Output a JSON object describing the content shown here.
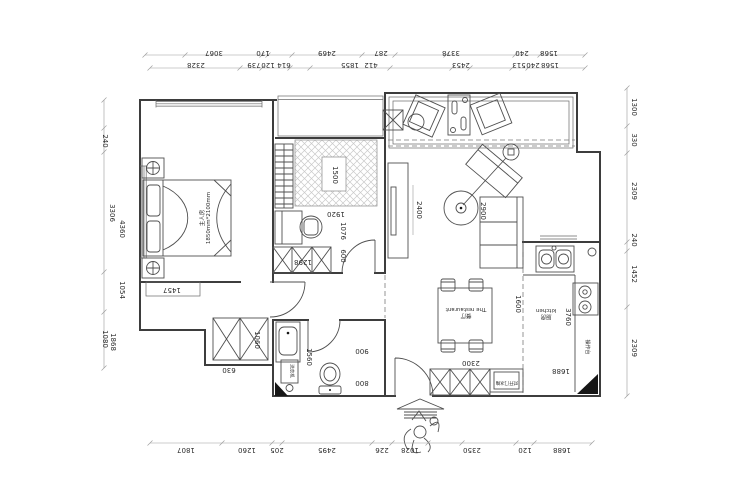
{
  "canvas": {
    "width": 740,
    "height": 500,
    "background": "#ffffff"
  },
  "colors": {
    "wall_line": "#3d3d3d",
    "furniture_line": "#4f4f4f",
    "dimension_line": "#9a9a9a",
    "text": "#2b2b2b",
    "hatch": "#c9c9c9",
    "solid_fill": "#161616"
  },
  "rooms": {
    "master_bedroom": {
      "name": "主人房",
      "size_note": "1850mm*2100mm"
    },
    "dining": {
      "name": "餐厅",
      "subtitle": "The restaurant"
    },
    "kitchen": {
      "name": "厨房",
      "subtitle": "kitchen"
    },
    "counter": {
      "name": "操作台"
    },
    "washing_machine": {
      "name": "洗衣机"
    },
    "fridge_cabinet": {
      "name": "对开门冰箱"
    }
  },
  "dimensions": {
    "top_row_1": [
      "3067",
      "170",
      "2469",
      "287",
      "3378",
      "240",
      "1568"
    ],
    "top_row_2": [
      "2328",
      "739",
      "120",
      "614",
      "1855",
      "412",
      "2453",
      "513",
      "240",
      "1568"
    ],
    "bottom_row": [
      "1807",
      "1260",
      "205",
      "2495",
      "226",
      "1028",
      "2350",
      "120",
      "1688"
    ],
    "left_column": [
      "240",
      "3306",
      "4360",
      "1054",
      "1080",
      "1868"
    ],
    "right_column": [
      "1300",
      "330",
      "2309",
      "240",
      "1452",
      "2309"
    ],
    "interior": [
      "1500",
      "1920",
      "1076",
      "600",
      "1298",
      "1457",
      "1060",
      "630",
      "1560",
      "900",
      "800",
      "2400",
      "2900",
      "1600",
      "3760",
      "2300",
      "1688"
    ]
  },
  "plan_labels": [
    {
      "name": "dim-label",
      "t": "3067",
      "x": 214,
      "y": 52,
      "r": 180
    },
    {
      "name": "dim-label",
      "t": "170",
      "x": 263,
      "y": 52,
      "r": 180
    },
    {
      "name": "dim-label",
      "t": "2469",
      "x": 327,
      "y": 52,
      "r": 180
    },
    {
      "name": "dim-label",
      "t": "287",
      "x": 381,
      "y": 52,
      "r": 180
    },
    {
      "name": "dim-label",
      "t": "3378",
      "x": 451,
      "y": 52,
      "r": 180
    },
    {
      "name": "dim-label",
      "t": "240",
      "x": 522,
      "y": 52,
      "r": 180
    },
    {
      "name": "dim-label",
      "t": "1568",
      "x": 549,
      "y": 52,
      "r": 180
    },
    {
      "name": "dim-label",
      "t": "2328",
      "x": 196,
      "y": 64,
      "r": 180
    },
    {
      "name": "dim-label",
      "t": "739",
      "x": 254,
      "y": 64,
      "r": 180
    },
    {
      "name": "dim-label",
      "t": "120",
      "x": 268,
      "y": 64,
      "r": 180
    },
    {
      "name": "dim-label",
      "t": "614",
      "x": 284,
      "y": 64,
      "r": 180
    },
    {
      "name": "dim-label",
      "t": "1855",
      "x": 350,
      "y": 64,
      "r": 180
    },
    {
      "name": "dim-label",
      "t": "412",
      "x": 371,
      "y": 64,
      "r": 180
    },
    {
      "name": "dim-label",
      "t": "2453",
      "x": 461,
      "y": 64,
      "r": 180
    },
    {
      "name": "dim-label",
      "t": "513",
      "x": 519,
      "y": 64,
      "r": 180
    },
    {
      "name": "dim-label",
      "t": "240",
      "x": 533,
      "y": 64,
      "r": 180
    },
    {
      "name": "dim-label",
      "t": "1568",
      "x": 550,
      "y": 64,
      "r": 180
    },
    {
      "name": "dim-label",
      "t": "1807",
      "x": 186,
      "y": 449,
      "r": 180
    },
    {
      "name": "dim-label",
      "t": "1260",
      "x": 247,
      "y": 449,
      "r": 180
    },
    {
      "name": "dim-label",
      "t": "205",
      "x": 277,
      "y": 449,
      "r": 180
    },
    {
      "name": "dim-label",
      "t": "2495",
      "x": 327,
      "y": 449,
      "r": 180
    },
    {
      "name": "dim-label",
      "t": "226",
      "x": 382,
      "y": 449,
      "r": 180
    },
    {
      "name": "dim-label",
      "t": "1028",
      "x": 410,
      "y": 449,
      "r": 180
    },
    {
      "name": "dim-label",
      "t": "2350",
      "x": 472,
      "y": 449,
      "r": 180
    },
    {
      "name": "dim-label",
      "t": "120",
      "x": 525,
      "y": 449,
      "r": 180
    },
    {
      "name": "dim-label",
      "t": "1688",
      "x": 562,
      "y": 449,
      "r": 180
    },
    {
      "name": "dim-label",
      "t": "240",
      "x": 104,
      "y": 141,
      "r": 90
    },
    {
      "name": "dim-label",
      "t": "3306",
      "x": 111,
      "y": 213,
      "r": 90
    },
    {
      "name": "dim-label",
      "t": "4360",
      "x": 121,
      "y": 229,
      "r": 90
    },
    {
      "name": "dim-label",
      "t": "1054",
      "x": 121,
      "y": 290,
      "r": 90
    },
    {
      "name": "dim-label",
      "t": "1080",
      "x": 104,
      "y": 339,
      "r": 90
    },
    {
      "name": "dim-label",
      "t": "1868",
      "x": 112,
      "y": 342,
      "r": 90
    },
    {
      "name": "dim-label",
      "t": "1300",
      "x": 633,
      "y": 107,
      "r": 90
    },
    {
      "name": "dim-label",
      "t": "330",
      "x": 633,
      "y": 140,
      "r": 90
    },
    {
      "name": "dim-label",
      "t": "2309",
      "x": 633,
      "y": 191,
      "r": 90
    },
    {
      "name": "dim-label",
      "t": "240",
      "x": 633,
      "y": 240,
      "r": 90
    },
    {
      "name": "dim-label",
      "t": "1452",
      "x": 633,
      "y": 274,
      "r": 90
    },
    {
      "name": "dim-label",
      "t": "2309",
      "x": 633,
      "y": 348,
      "r": 90
    },
    {
      "name": "dim-label",
      "t": "1500",
      "x": 334,
      "y": 175,
      "r": 90
    },
    {
      "name": "dim-label",
      "t": "1920",
      "x": 336,
      "y": 213,
      "r": 180
    },
    {
      "name": "dim-label",
      "t": "1076",
      "x": 342,
      "y": 231,
      "r": 90
    },
    {
      "name": "dim-label",
      "t": "600",
      "x": 342,
      "y": 256,
      "r": 90
    },
    {
      "name": "dim-label",
      "t": "1298",
      "x": 303,
      "y": 261,
      "r": 180
    },
    {
      "name": "dim-label",
      "t": "1457",
      "x": 172,
      "y": 289,
      "r": 180
    },
    {
      "name": "dim-label",
      "t": "1060",
      "x": 256,
      "y": 340,
      "r": 90
    },
    {
      "name": "dim-label",
      "t": "630",
      "x": 229,
      "y": 369,
      "r": 180
    },
    {
      "name": "dim-label",
      "t": "1560",
      "x": 308,
      "y": 357,
      "r": 90
    },
    {
      "name": "dim-label",
      "t": "900",
      "x": 362,
      "y": 350,
      "r": 180
    },
    {
      "name": "dim-label",
      "t": "800",
      "x": 362,
      "y": 382,
      "r": 180
    },
    {
      "name": "dim-label",
      "t": "2400",
      "x": 418,
      "y": 210,
      "r": 90
    },
    {
      "name": "dim-label",
      "t": "2900",
      "x": 482,
      "y": 211,
      "r": 90
    },
    {
      "name": "dim-label",
      "t": "1600",
      "x": 517,
      "y": 304,
      "r": 90
    },
    {
      "name": "dim-label",
      "t": "3760",
      "x": 567,
      "y": 317,
      "r": 90
    },
    {
      "name": "dim-label",
      "t": "2300",
      "x": 471,
      "y": 362,
      "r": 180
    },
    {
      "name": "dim-label",
      "t": "1688",
      "x": 561,
      "y": 370,
      "r": 180
    },
    {
      "name": "room-label-master-bedroom",
      "lines": [
        "主人房",
        "1850mm*2100mm"
      ],
      "x": 206,
      "y": 218,
      "r": -90,
      "s": 5.5
    },
    {
      "name": "room-label-dining",
      "lines": [
        "餐厅",
        "The restaurant"
      ],
      "x": 466,
      "y": 312,
      "r": 180,
      "s": 5.5
    },
    {
      "name": "room-label-kitchen",
      "lines": [
        "厨房",
        "kitchen"
      ],
      "x": 546,
      "y": 313,
      "r": 180,
      "s": 5.5
    },
    {
      "name": "label-counter",
      "t": "操作台",
      "x": 586,
      "y": 347,
      "r": 90,
      "s": 5
    },
    {
      "name": "label-washing-machine",
      "t": "洗衣机",
      "x": 290,
      "y": 371,
      "r": 90,
      "s": 4.5
    },
    {
      "name": "label-fridge",
      "t": "对开门冰箱",
      "x": 507,
      "y": 381,
      "r": 180,
      "s": 4.5
    }
  ],
  "dim_lines": [
    {
      "o": "h",
      "y": 55,
      "x1": 145,
      "x2": 585,
      "ticks": [
        145,
        185,
        262,
        268,
        292,
        362,
        395,
        446,
        515,
        540,
        585
      ]
    },
    {
      "o": "h",
      "y": 68,
      "x1": 150,
      "x2": 585,
      "ticks": [
        150,
        240,
        262,
        290,
        310,
        390,
        452,
        470,
        512,
        528,
        585
      ]
    },
    {
      "o": "h",
      "y": 443,
      "x1": 150,
      "x2": 592,
      "ticks": [
        150,
        222,
        272,
        282,
        372,
        392,
        428,
        462,
        516,
        534,
        592
      ]
    },
    {
      "o": "v",
      "x": 104,
      "y1": 100,
      "y2": 368,
      "ticks": [
        100,
        128,
        152,
        272,
        312,
        368
      ]
    },
    {
      "o": "v",
      "x": 627,
      "y1": 88,
      "y2": 396,
      "ticks": [
        88,
        126,
        153,
        242,
        251,
        307,
        396
      ]
    }
  ]
}
